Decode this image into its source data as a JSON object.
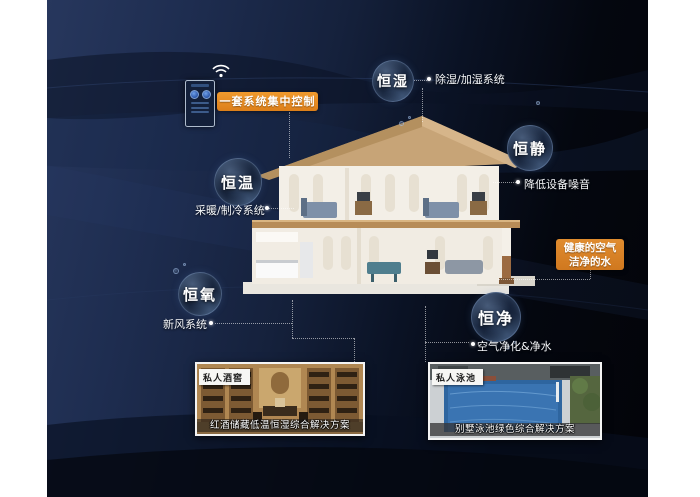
{
  "title": "恒温恒湿智能家居系统示意图",
  "control": {
    "label": "一套系统集中控制",
    "device": "wall-control-panel",
    "wifi": "wifi-signal"
  },
  "bubbles": [
    {
      "id": "hengshi",
      "label": "恒湿",
      "desc": "除湿/加湿系统"
    },
    {
      "id": "hengjing",
      "label": "恒静",
      "desc": "降低设备噪音"
    },
    {
      "id": "hengwen",
      "label": "恒温",
      "desc": "采暖/制冷系统"
    },
    {
      "id": "hengyang",
      "label": "恒氧",
      "desc": "新风系统"
    },
    {
      "id": "hengjin",
      "label": "恒净",
      "desc": "空气净化&净水"
    }
  ],
  "highlight_box": {
    "line1": "健康的空气",
    "line2": "洁净的水"
  },
  "cards": [
    {
      "tag": "私人酒窖",
      "caption": "红酒储藏低温恒湿综合解决方案"
    },
    {
      "tag": "私人泳池",
      "caption": "别墅泳池绿色综合解决方案"
    }
  ],
  "colors": {
    "accent_orange": "#E0861F",
    "background_navy": "#1E2D50",
    "background_black": "#03040A",
    "bubble_rim": "#A0C3F5",
    "text": "#FFFFFF"
  }
}
